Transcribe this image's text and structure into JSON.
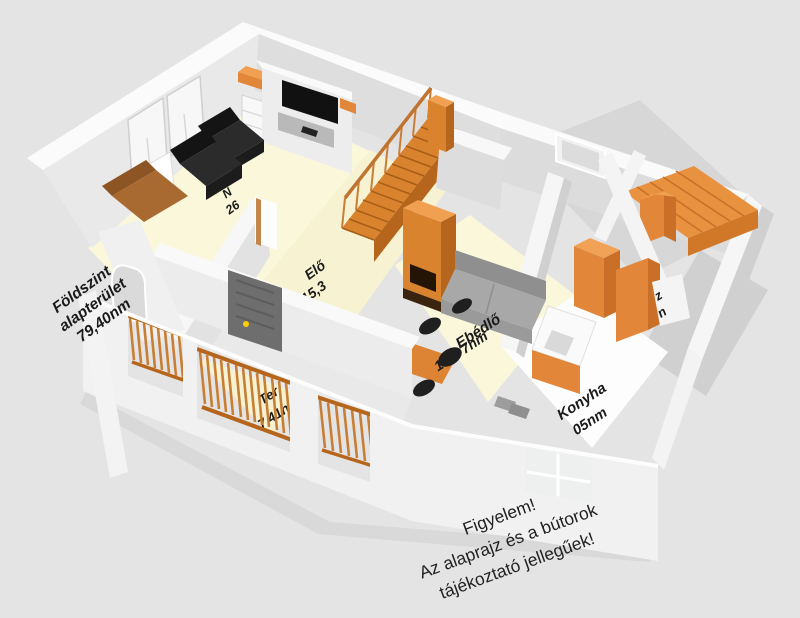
{
  "scene": {
    "description_visible_type": "3D floor plan render",
    "palette": {
      "background": "#e4e4e4",
      "wall_white": "#f4f4f4",
      "wall_top": "#fbfbfb",
      "wall_shadow": "#d6d6d6",
      "floor_cream": "#faf7da",
      "floor_kitchen": "#fdfdfd",
      "floor_gray": "#d7d7d7",
      "accent_orange": "#e2873a",
      "orange_dark": "#b5661c",
      "orange_light": "#f0a050",
      "railing_orange": "#c87f35",
      "furniture_black": "#1d1d1d",
      "sofa_gray": "#9a9a9a",
      "door_gray": "#6e6e6e",
      "door_knob_yellow": "#ffcc00",
      "text_color": "#1b1b1b"
    }
  },
  "annotations": {
    "floor_summary": {
      "line1": "Földszint",
      "line2": "alapterület",
      "line3": "79,40nm"
    },
    "disclaimer": {
      "line1": "Figyelem!",
      "line2": "Az alaprajz és a bútorok",
      "line3": "tájékoztató jellegűek!"
    }
  },
  "room_labels": {
    "nappali": {
      "name_fragment": "N",
      "area_fragment": "26"
    },
    "eloszoba": {
      "name_fragment": "Elő",
      "area_fragment": "15,3"
    },
    "ebedlo": {
      "name": "Ebédlő",
      "area_prefix": "1",
      "area_suffix": "7nm"
    },
    "konyha": {
      "name": "Konyha",
      "area_fragment": "05nm"
    },
    "terasz": {
      "name_fragment": "Ter",
      "area_fragment": "7,41n"
    },
    "unknown_right": {
      "fragment_top": "z",
      "fragment_bottom": "n"
    }
  }
}
